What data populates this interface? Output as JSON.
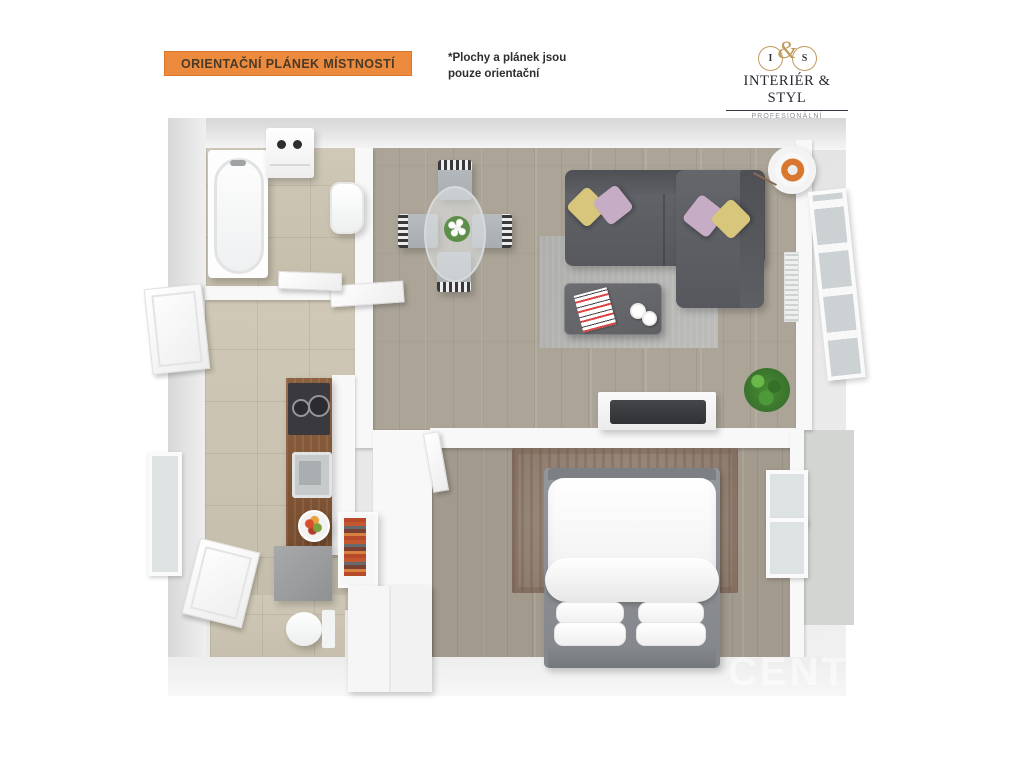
{
  "header": {
    "banner_label": "ORIENTAČNÍ PLÁNEK MÍSTNOSTÍ",
    "note": {
      "line1": "*Plochy  a plánek jsou",
      "line2": "pouze orientační"
    },
    "logo": {
      "monogram": {
        "left": "I",
        "amp": "&",
        "right": "S"
      },
      "name": "INTERIÉR & STYL",
      "tagline": "PROFESIONÁLNÍ PREZENTACE"
    }
  },
  "floorplan": {
    "watermark": "CENT"
  },
  "palette": {
    "accent_orange": "#EC8B3E",
    "accent_border": "#D8762B",
    "banner_text": "#4A3A28",
    "note_text": "#2E2E2E",
    "gold": "#C09A5B",
    "logo_text": "#2B2733",
    "tagline_gray": "#8F8F99",
    "tile": "#CDC5B2",
    "wood_living": "#ABA497",
    "wood_bed": "#A29A8D",
    "sofa_gray": "#5B5D62",
    "pillow_yellow": "#D8C67C",
    "pillow_pink": "#C6ADC5",
    "rug_gray": "#B8B8B6",
    "rug_taupe": "#9C8A7B",
    "counter_wood": "#875835",
    "plant_green": "#478C33",
    "lamp_orange": "#D9772E",
    "watermark": "#FFFFFF"
  }
}
